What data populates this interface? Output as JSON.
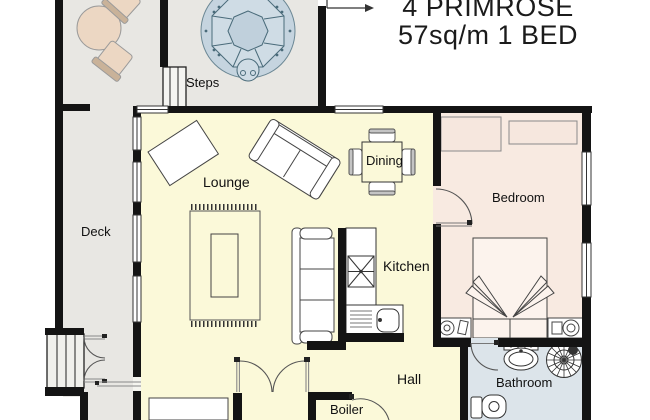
{
  "title": {
    "line1": "4 PRIMROSE",
    "line2": "57sq/m 1 BED"
  },
  "labels": {
    "steps": "Steps",
    "deck": "Deck",
    "lounge": "Lounge",
    "dining": "Dining",
    "bedroom": "Bedroom",
    "kitchen": "Kitchen",
    "hall": "Hall",
    "bathroom": "Bathroom",
    "boiler": "Boiler"
  },
  "colors": {
    "wall": "#141414",
    "deck_floor": "#e8e7e3",
    "living_floor": "#fbf9d9",
    "bedroom_floor": "#f8eae1",
    "bathroom_floor": "#dce4ea",
    "hot_tub": "#c5d4df",
    "hot_tub_line": "#4a6b7a",
    "outdoor_furniture": "#ecd7c3"
  }
}
